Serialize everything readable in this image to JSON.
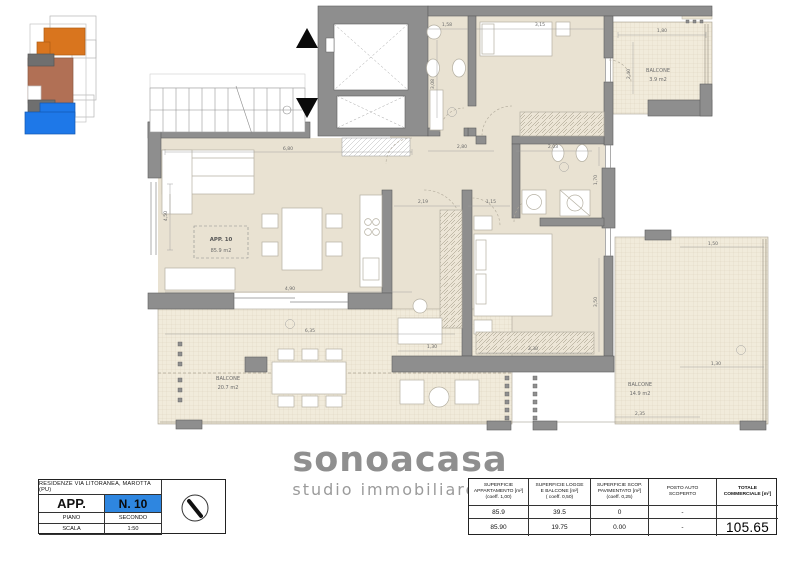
{
  "plan": {
    "app_label": {
      "line1": "APP. 10",
      "line2": "85.9 m2"
    },
    "balconies": {
      "top_right": {
        "label": "BALCONE",
        "area": "3.9 m2"
      },
      "bottom_left": {
        "label": "BALCONE",
        "area": "20.7 m2"
      },
      "bottom_right": {
        "label": "BALCONE",
        "area": "14.9 m2"
      }
    },
    "dims": [
      {
        "t": "6,80",
        "x": 288,
        "y": 150
      },
      {
        "t": "4,50",
        "x": 167,
        "y": 216,
        "r": -90
      },
      {
        "t": "4,90",
        "x": 290,
        "y": 290
      },
      {
        "t": "1,58",
        "x": 447,
        "y": 26
      },
      {
        "t": "3,15",
        "x": 540,
        "y": 26
      },
      {
        "t": "1,80",
        "x": 662,
        "y": 32
      },
      {
        "t": "2,40",
        "x": 630,
        "y": 74,
        "r": -90
      },
      {
        "t": "3,08",
        "x": 434,
        "y": 84,
        "r": -90
      },
      {
        "t": "2,80",
        "x": 462,
        "y": 148
      },
      {
        "t": "2,03",
        "x": 553,
        "y": 148
      },
      {
        "t": "2,19",
        "x": 423,
        "y": 203
      },
      {
        "t": "1,15",
        "x": 491,
        "y": 203
      },
      {
        "t": "1,70",
        "x": 597,
        "y": 180,
        "r": -90
      },
      {
        "t": "3,50",
        "x": 597,
        "y": 302,
        "r": -90
      },
      {
        "t": "1,30",
        "x": 432,
        "y": 348
      },
      {
        "t": "3,30",
        "x": 533,
        "y": 350
      },
      {
        "t": "6,35",
        "x": 310,
        "y": 332
      },
      {
        "t": "1,50",
        "x": 713,
        "y": 245
      },
      {
        "t": "1,30",
        "x": 716,
        "y": 365
      },
      {
        "t": "2,35",
        "x": 640,
        "y": 415
      }
    ]
  },
  "key_plan": {
    "colors": {
      "orange": "#d9751e",
      "gray": "#6f6f6f",
      "brown": "#b17055",
      "blue": "#1e78e8"
    }
  },
  "logo": {
    "name": "sonoacasa",
    "tagline": "studio immobiliare"
  },
  "info_table": {
    "title": "RESIDENZE VIA LITORANEA, MAROTTA (PU)",
    "unit_label": "APP.",
    "unit_value": "N. 10",
    "floor_label": "PIANO",
    "floor_value": "SECONDO",
    "scale_label": "SCALA",
    "scale_value": "1:50",
    "highlight_color": "#2e86e0"
  },
  "area_table": {
    "headers": [
      [
        "SUPERFICIE",
        "APPARTAMENTO [m²]",
        "(coeff. 1,00)"
      ],
      [
        "SUPERFICIE LOGGE",
        "E BALCONE [m²]",
        "( coeff. 0,50)"
      ],
      [
        "SUPERFICIE SCOP.",
        "PAVIMENTATO [m²]",
        "(coeff. 0,25)"
      ],
      [
        "POSTO AUTO",
        "SCOPERTO",
        ""
      ],
      [
        "TOTALE",
        "COMMERCIALE [m²]",
        ""
      ]
    ],
    "row1": [
      "85.9",
      "39.5",
      "0",
      "-",
      ""
    ],
    "row2": [
      "85.90",
      "19.75",
      "0.00",
      "-",
      "105.65"
    ]
  }
}
